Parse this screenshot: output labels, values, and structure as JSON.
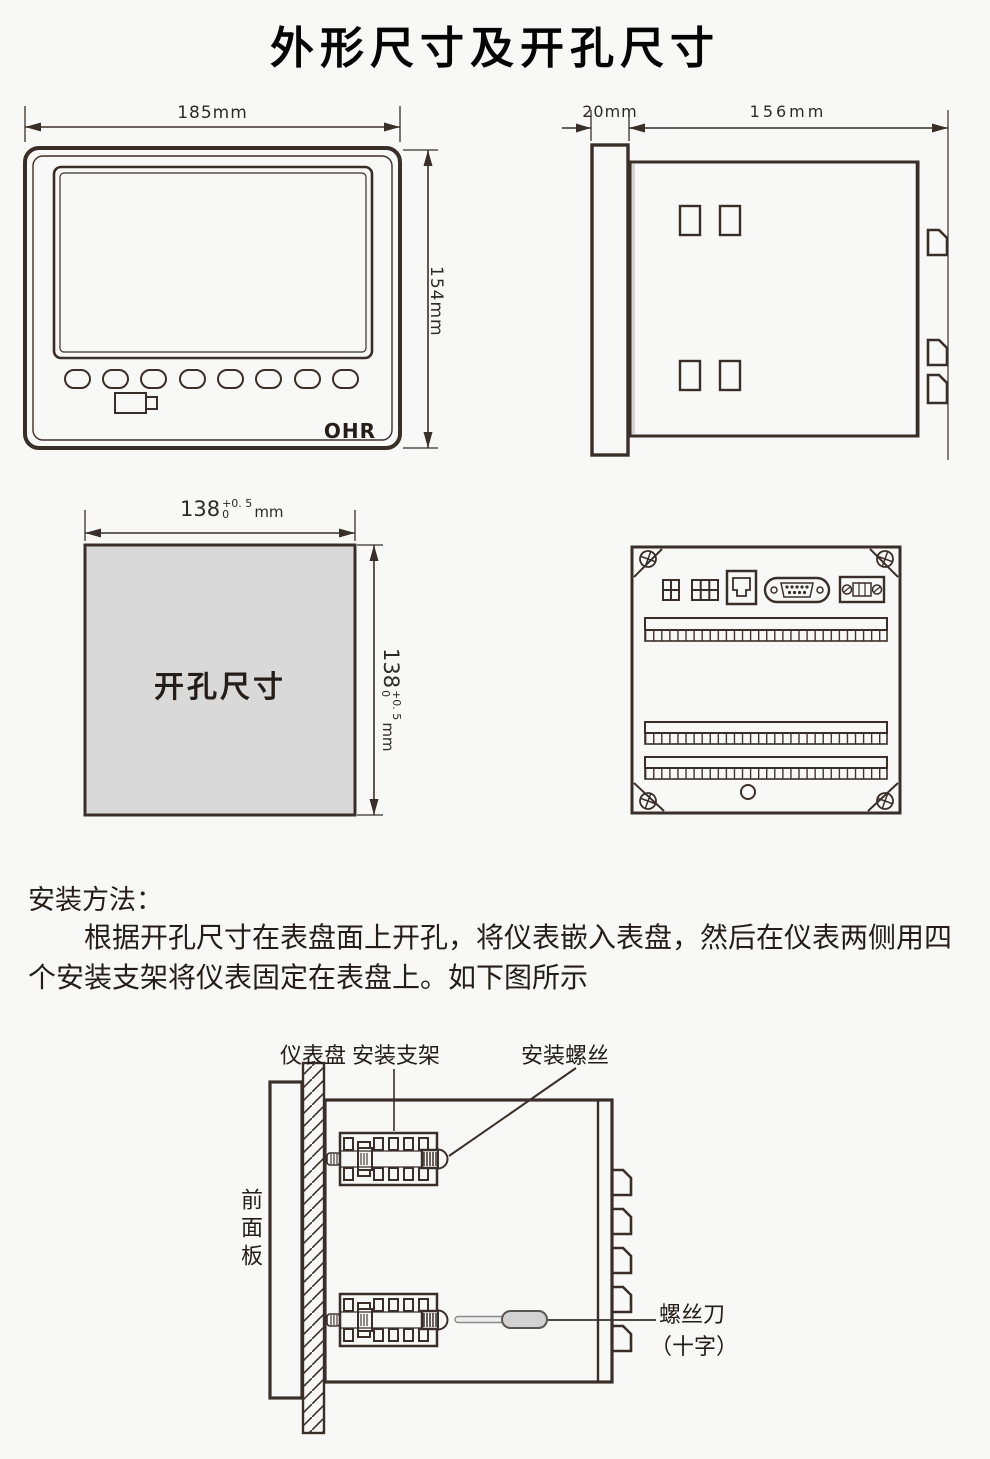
{
  "title": "外形尺寸及开孔尺寸",
  "front_view": {
    "width_label": "185mm",
    "height_label": "154mm",
    "logo": "OHR"
  },
  "side_view": {
    "bezel_depth_label": "20mm",
    "body_depth_label": "156mm"
  },
  "cutout": {
    "area_label": "开孔尺寸",
    "dim_value": "138",
    "dim_tolerance_upper": "+0. 5",
    "dim_tolerance_lower": "0",
    "dim_unit": "mm"
  },
  "installation": {
    "heading": "安装方法：",
    "paragraph_line1": "根据开孔尺寸在表盘面上开孔，将仪表嵌入表盘，然后在仪表两侧用四",
    "paragraph_line2": "个安装支架将仪表固定在表盘上。如下图所示"
  },
  "installation_diagram": {
    "panel_label": "仪表盘",
    "bracket_label": "安装支架",
    "screw_label": "安装螺丝",
    "front_panel_label": "前面板",
    "screwdriver_label_line1": "螺丝刀",
    "screwdriver_label_line2": "（十字）"
  },
  "colors": {
    "line": "#3a2f28",
    "cutout_fill": "#d9d9d9",
    "text": "#1a1a1a"
  }
}
